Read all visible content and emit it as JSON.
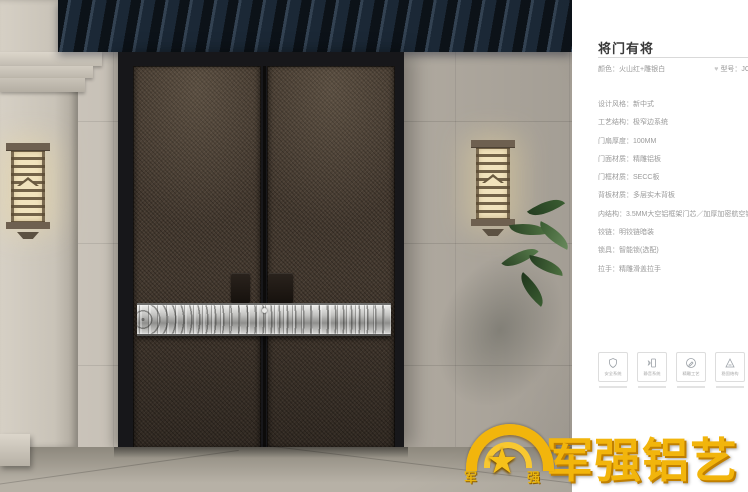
{
  "product": {
    "title": "将门有将",
    "color_line": "颜色：火山红+雕银白",
    "model_line": "型号：JC",
    "specs": [
      "设计风格：新中式",
      "工艺结构：极窄边系统",
      "门扇厚度：100MM",
      "门面材质：精雕铝板",
      "门框材质：SECC板",
      "背板材质：多层实木背板",
      "内结构：3.5MM大空铝框架门芯／加厚加密航空铝蜂",
      "铰链：明铰链暗装",
      "锁具：智能锁(选配)",
      "拉手：精雕滑盖拉手"
    ],
    "features": [
      {
        "label": "安全系统"
      },
      {
        "label": "静音系统"
      },
      {
        "label": "精雕工艺"
      },
      {
        "label": "稳固结构"
      }
    ]
  },
  "icons": {
    "favorite": "♥",
    "star": "★"
  },
  "brand": {
    "logo_text": "军强铝艺",
    "emblem_left_char": "军",
    "emblem_right_char": "强",
    "gold": "#f2b50c"
  },
  "colors": {
    "title_text": "#3a3a3a",
    "spec_text": "#9a9a9a",
    "divider": "#d9d9d9",
    "door_bronze": "#43382e",
    "eave_blue": "#1b2836",
    "band_silver": "#c2c2c0"
  }
}
